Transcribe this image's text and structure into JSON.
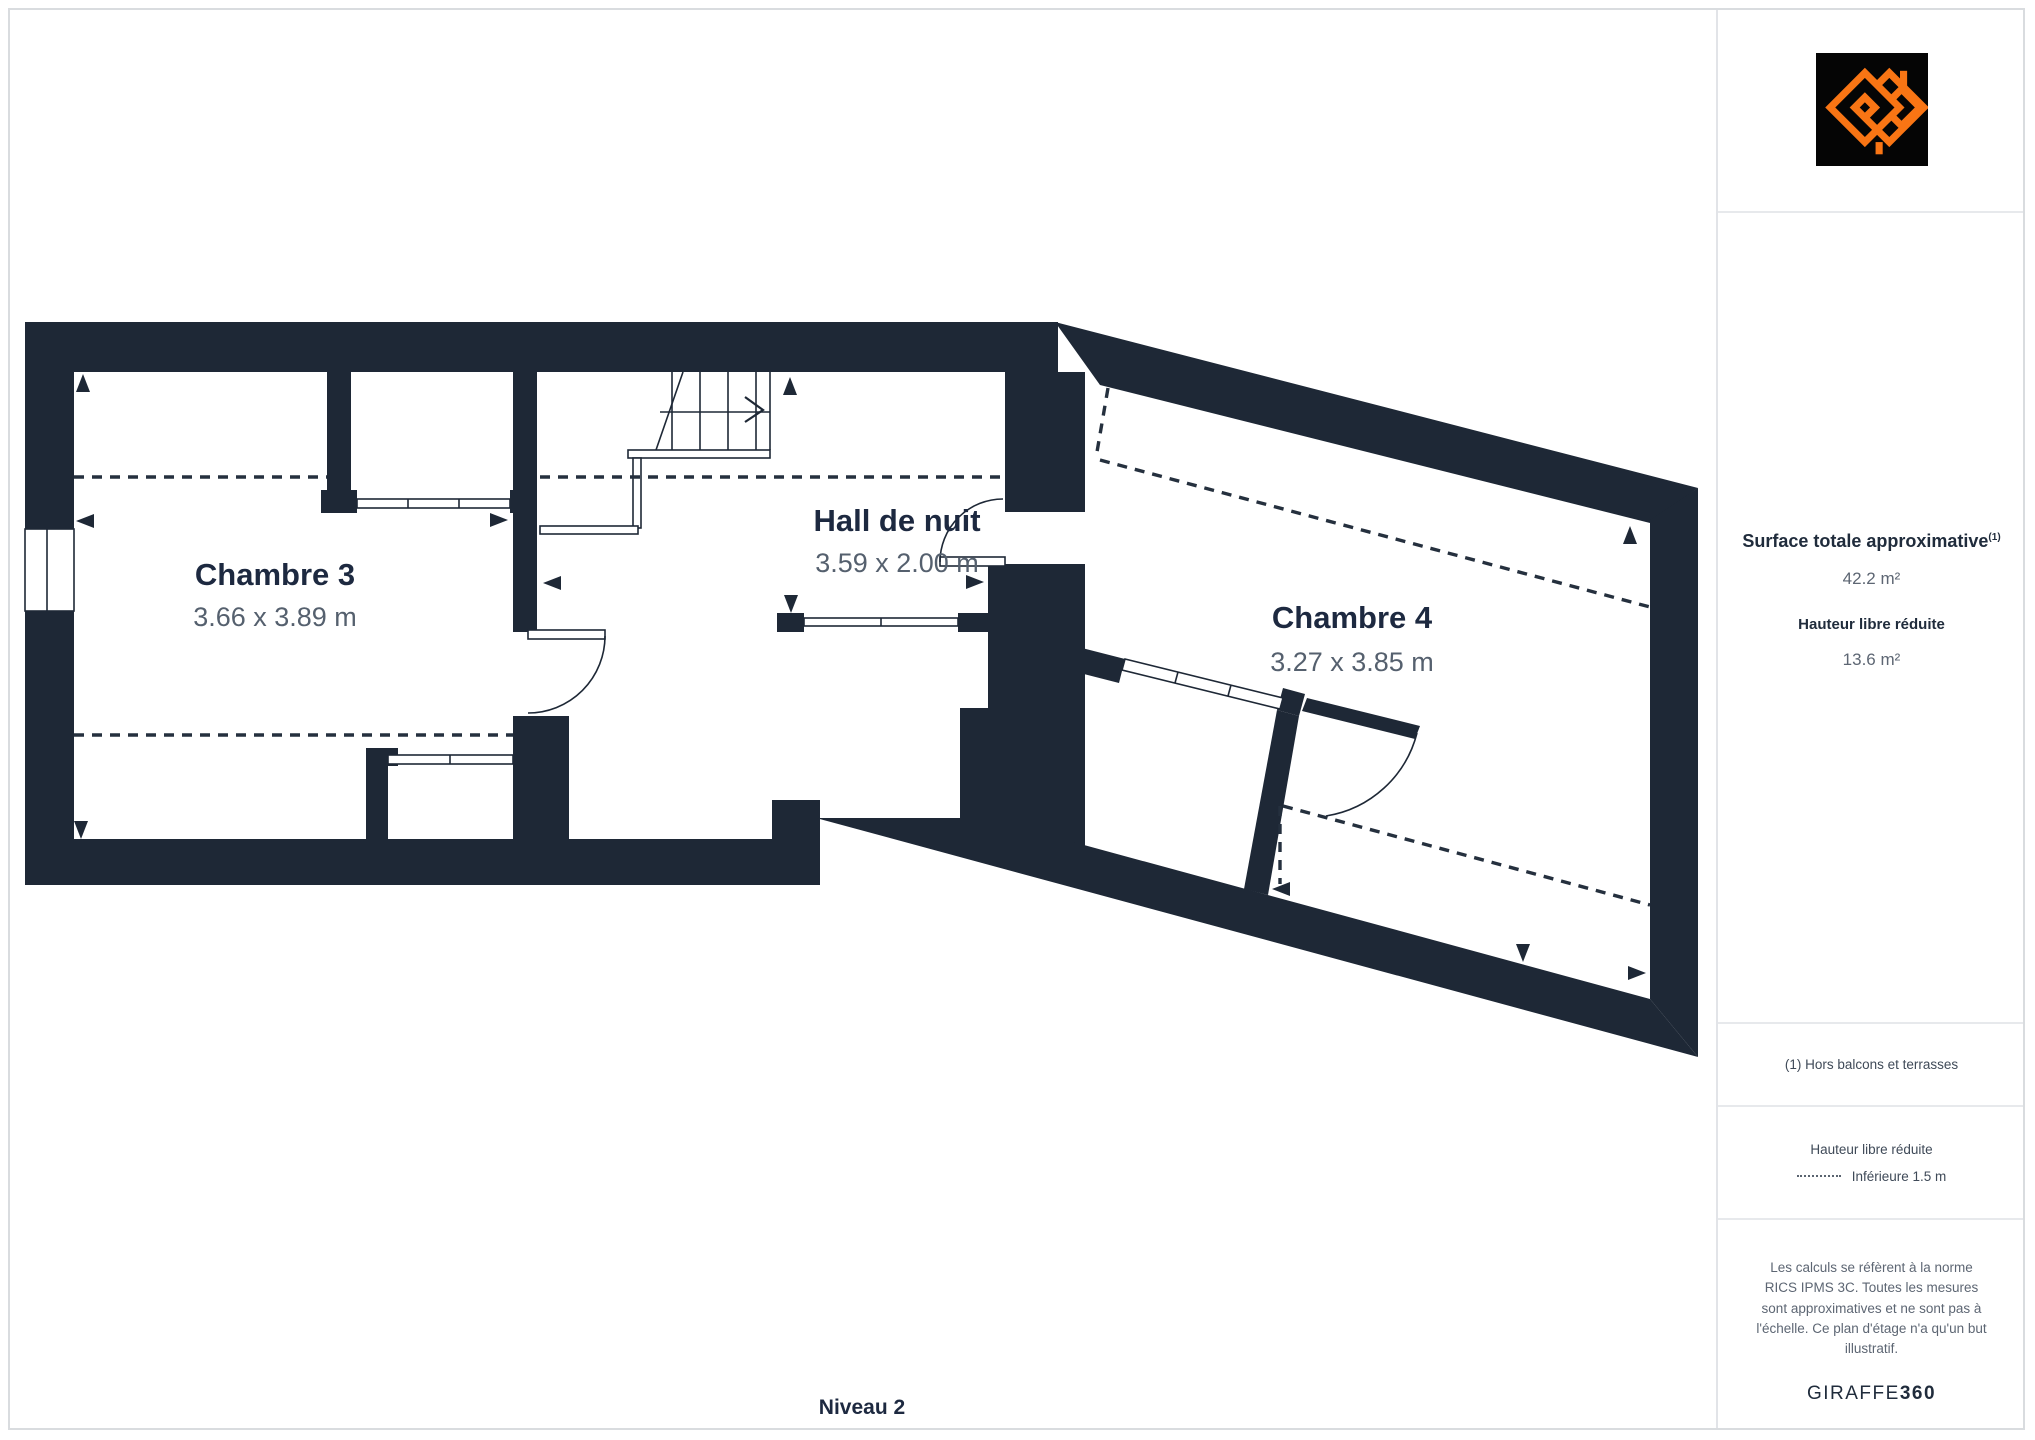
{
  "plan": {
    "wall_color": "#1e2836",
    "level_label": "Niveau 2",
    "rooms": [
      {
        "id": "chambre3",
        "name": "Chambre 3",
        "dims": "3.66 x 3.89 m"
      },
      {
        "id": "hall",
        "name": "Hall de nuit",
        "dims": "3.59 x 2.00 m"
      },
      {
        "id": "chambre4",
        "name": "Chambre 4",
        "dims": "3.27 x 3.85 m"
      }
    ]
  },
  "sidebar": {
    "surface_title": "Surface totale approximative",
    "surface_sup": "(1)",
    "surface_value": "42.2 m²",
    "reduced_title": "Hauteur libre réduite",
    "reduced_value": "13.6 m²",
    "footnote": "(1) Hors balcons et terrasses",
    "legend_title": "Hauteur libre réduite",
    "legend_item": "Inférieure 1.5 m",
    "disclaimer": "Les calculs se réfèrent à la norme RICS IPMS 3C. Toutes les mesures sont approximatives et ne sont pas à l'échelle. Ce plan d'étage n'a qu'un but illustratif.",
    "brand_name": "GIRAFFE",
    "brand_suffix": "360",
    "logo_colors": {
      "background": "#050505",
      "mark": "#f97514"
    }
  }
}
